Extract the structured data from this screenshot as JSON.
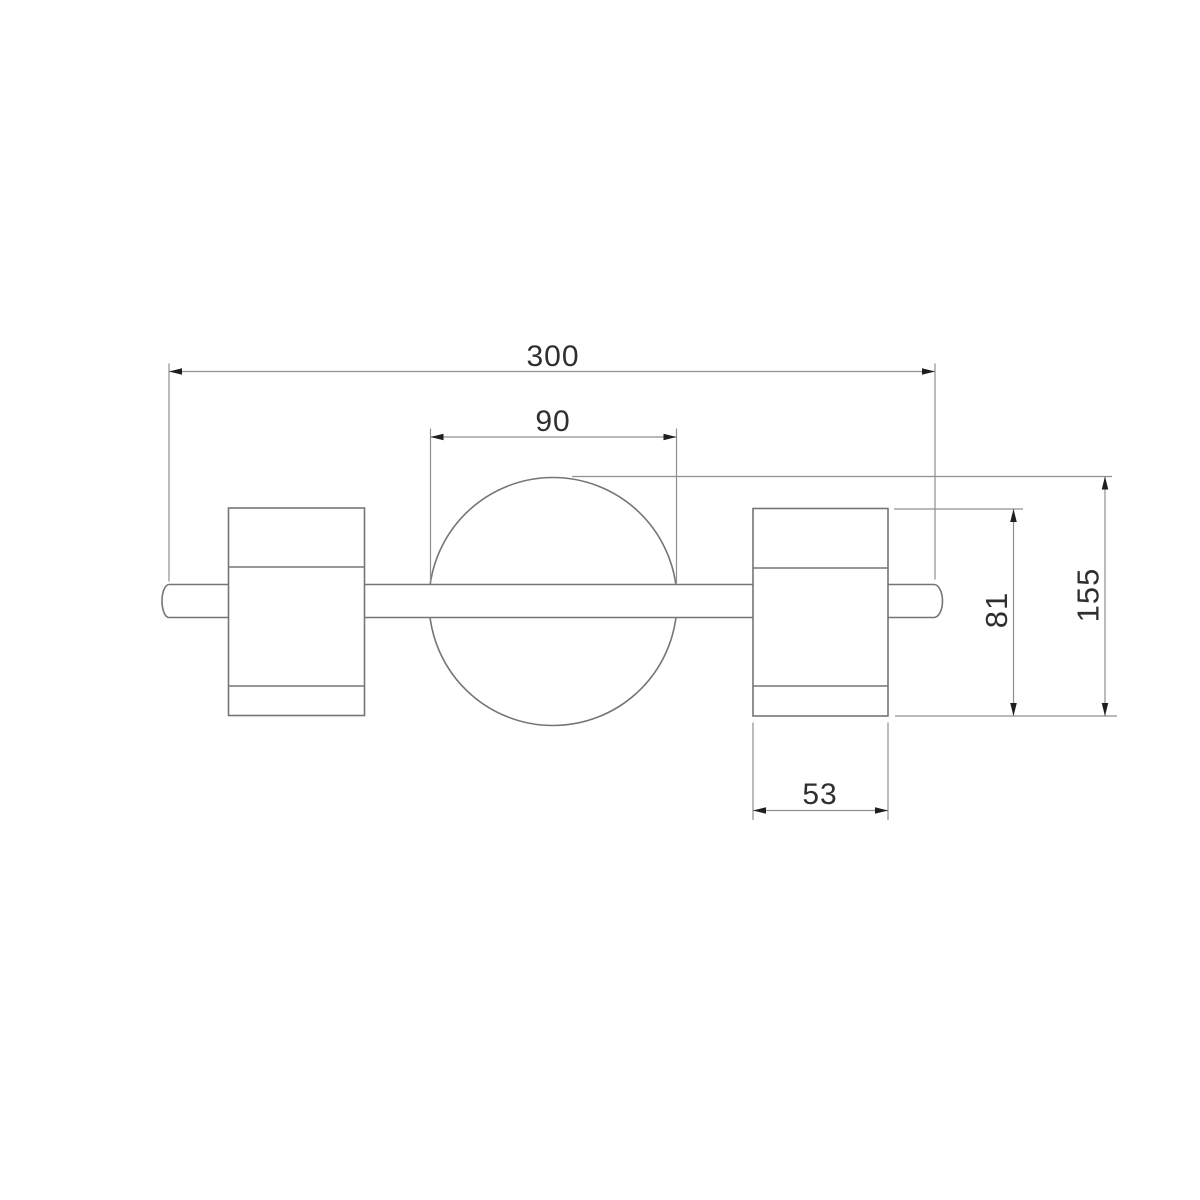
{
  "drawing": {
    "type": "technical-dimension-drawing",
    "subject": "two-spot wall light fixture, front view",
    "dimensions": {
      "overall_width": {
        "label": "300",
        "meaning": "overall bar width"
      },
      "plate_diameter": {
        "label": "90",
        "meaning": "central round plate diameter"
      },
      "spot_height": {
        "label": "81",
        "meaning": "spot cylinder height"
      },
      "overall_height": {
        "label": "155",
        "meaning": "overall fixture height"
      },
      "spot_width": {
        "label": "53",
        "meaning": "spot cylinder width"
      }
    },
    "colors": {
      "background": "#ffffff",
      "outline": "#757575",
      "dimension_line": "#8f8f8f",
      "arrow": "#1f1f1f",
      "text": "#2f2f2f"
    }
  }
}
